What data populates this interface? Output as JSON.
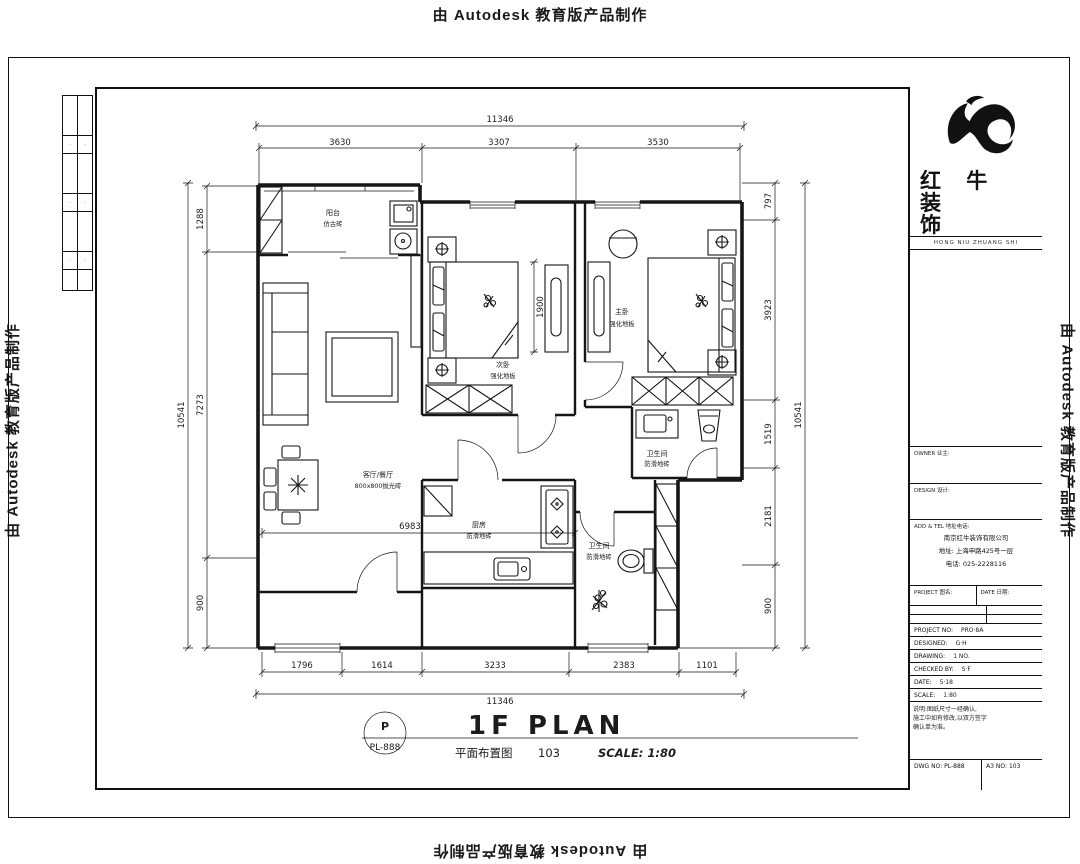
{
  "watermark": {
    "text": "由 Autodesk 教育版产品制作"
  },
  "logo": {
    "line1": "红 牛 装",
    "line2": "饰",
    "subtext": "HONG NIU ZHUANG SHI"
  },
  "revision_strip": {
    "cells": [
      "·",
      "·",
      "·",
      "·",
      "·",
      "·"
    ]
  },
  "title_block": {
    "owner_header": "OWNER 业主:",
    "design_header": "DESIGN 设计:",
    "company_header": "ADD & TEL 地址电话:",
    "company_name": "南京红牛装饰有限公司",
    "company_address": "地址: 上海申路425号一层",
    "company_phone": "电话: 025-2228116",
    "row_left": "PROJECT 图名:",
    "row_right": "DATE 日期:",
    "fields": [
      {
        "label": "PROJECT NO:",
        "value": "PRO·8A"
      },
      {
        "label": "DESIGNED:",
        "value": "G·H"
      },
      {
        "label": "DRAWING:",
        "value": "1 NO."
      },
      {
        "label": "CHECKED BY:",
        "value": "S·F"
      },
      {
        "label": "DATE:",
        "value": "5·18"
      },
      {
        "label": "SCALE:",
        "value": "1:80"
      }
    ],
    "notes": [
      "说明:图纸尺寸一经确认,",
      "施工中如有修改,以双方签字",
      "确认单为准。"
    ],
    "dwg_no_label": "DWG NO: PL-888",
    "sheet_label": "A3 NO: 103"
  },
  "drawing_title": {
    "bubble_top": "P",
    "bubble_bottom": "PL-888",
    "title": "1F PLAN",
    "subtitle": "平面布置图",
    "sheet_no": "103",
    "scale": "SCALE: 1:80"
  },
  "dimensions": {
    "top": {
      "overall": "11346",
      "segments": [
        "3630",
        "3307",
        "3530"
      ]
    },
    "bottom": {
      "overall": "11346",
      "segments": [
        "1796",
        "1614",
        "3233",
        "2383",
        "1101"
      ]
    },
    "left": {
      "overall": "10541",
      "segments": [
        "1288",
        "7273",
        "900"
      ]
    },
    "right": {
      "overall": "10541",
      "segments": [
        "797",
        "3923",
        "1519",
        "2181",
        "900"
      ]
    },
    "interior": {
      "bed1": "1900",
      "kitchen": "6983"
    }
  },
  "rooms": {
    "balcony": {
      "name": "阳台",
      "finish": "仿古砖"
    },
    "living": {
      "name": "客厅/餐厅",
      "finish": "800x800抛光砖"
    },
    "bedroom1": {
      "name": "次卧",
      "finish": "强化地板"
    },
    "bedroom2": {
      "name": "主卧",
      "finish": "强化地板"
    },
    "bath1": {
      "name": "卫生间",
      "finish": "防滑地砖"
    },
    "kitchen": {
      "name": "厨房",
      "finish": "防滑地砖"
    },
    "bath2": {
      "name": "卫生间",
      "finish": "防滑地砖"
    }
  }
}
